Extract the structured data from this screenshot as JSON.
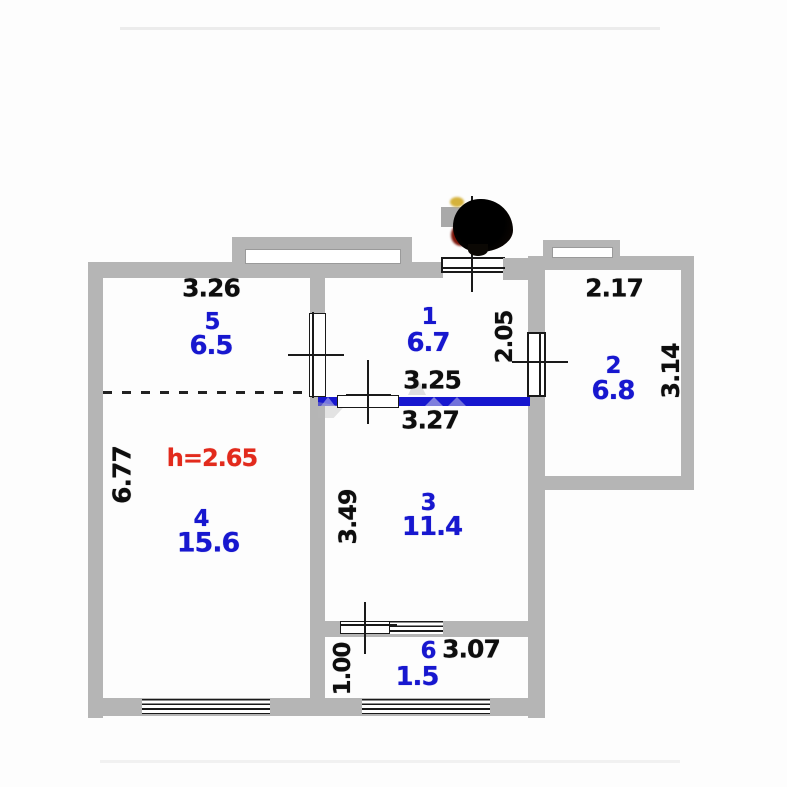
{
  "plan": {
    "ceiling_height_note": "h=2.65",
    "rooms": {
      "r5": {
        "num": "5",
        "area": "6.5"
      },
      "r1": {
        "num": "1",
        "area": "6.7"
      },
      "r2": {
        "num": "2",
        "area": "6.8"
      },
      "r4": {
        "num": "4",
        "area": "15.6"
      },
      "r3": {
        "num": "3",
        "area": "11.4"
      },
      "r6": {
        "num": "6",
        "area": "1.5"
      }
    },
    "dims": {
      "room5_top": "3.26",
      "room2_top": "2.17",
      "room1_right": "2.05",
      "room2_right": "3.14",
      "opening_above": "3.25",
      "opening_below": "3.27",
      "room4_left": "6.77",
      "room3_left": "3.49",
      "balcony_top": "3.07",
      "balcony_left": "1.00"
    },
    "colors": {
      "wall": "#b5b5b5",
      "room_label": "#1717cf",
      "dimension_text": "#0e0e0e",
      "height_note": "#e22a1c",
      "highlighted_wall": "#1717cf"
    }
  }
}
